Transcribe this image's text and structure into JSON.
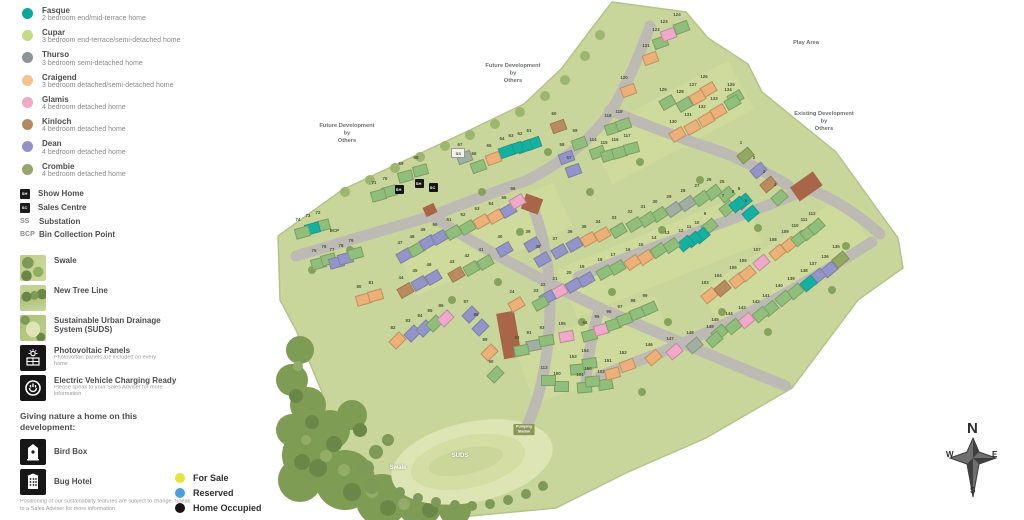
{
  "legend": {
    "house_types": [
      {
        "name": "Fasque",
        "desc": "2 bedroom end/mid-terrace home",
        "color": "#0aa79a"
      },
      {
        "name": "Cupar",
        "desc": "3 bedroom end-terrace/semi-detached home",
        "color": "#c6da85"
      },
      {
        "name": "Thurso",
        "desc": "3 bedroom semi-detached home",
        "color": "#8e9496"
      },
      {
        "name": "Craigend",
        "desc": "3 bedroom detached/semi-detached home",
        "color": "#f2c38e"
      },
      {
        "name": "Glamis",
        "desc": "4 bedroom detached home",
        "color": "#efaac6"
      },
      {
        "name": "Kinloch",
        "desc": "4 bedroom detached home",
        "color": "#b58a62"
      },
      {
        "name": "Dean",
        "desc": "4 bedroom detached home",
        "color": "#9590c9"
      },
      {
        "name": "Crombie",
        "desc": "4 bedroom detached home",
        "color": "#95a56b"
      }
    ],
    "markers": [
      {
        "code": "SH",
        "label": "Show Home",
        "style": "badge"
      },
      {
        "code": "SC",
        "label": "Sales Centre",
        "style": "badge"
      },
      {
        "code": "SS",
        "label": "Substation",
        "style": "text"
      },
      {
        "code": "BCP",
        "label": "Bin Collection Point",
        "style": "text"
      }
    ],
    "features": [
      {
        "label": "Swale",
        "icon": "swale-thumbnail",
        "thumb": "thumb-swale",
        "note": ""
      },
      {
        "label": "New Tree Line",
        "icon": "tree-line-thumbnail",
        "thumb": "thumb-tree",
        "note": ""
      },
      {
        "label": "Sustainable Urban Drainage System (SUDS)",
        "icon": "suds-thumbnail",
        "thumb": "thumb-suds",
        "note": ""
      },
      {
        "label": "Photovoltaic Panels",
        "icon": "pv-icon",
        "thumb": "",
        "note": "Photovoltaic panels are included on every home"
      },
      {
        "label": "Electric Vehicle Charging Ready",
        "icon": "ev-icon",
        "thumb": "",
        "note": "Please speak to your Sales Adviser for more information"
      }
    ],
    "nature_heading": "Giving nature a home on this development:",
    "nature_items": [
      {
        "label": "Bird Box",
        "icon": "bird-box-icon"
      },
      {
        "label": "Bug Hotel",
        "icon": "bug-hotel-icon"
      }
    ],
    "disclaimer": "Positioning of our sustainability features are subject to change. Speak to a Sales Adviser for more information.",
    "status": [
      {
        "label": "For Sale",
        "color": "#e8e23d"
      },
      {
        "label": "Reserved",
        "color": "#4a9fe0"
      },
      {
        "label": "Home Occupied",
        "color": "#1a1214"
      }
    ]
  },
  "map": {
    "palette": {
      "teal": "#12b2a3",
      "green": "#90bf7b",
      "gray": "#9fafa3",
      "orange": "#edb077",
      "pink": "#f0a8cb",
      "brown": "#bb8a5f",
      "purple": "#9294cb",
      "olive": "#93a961"
    },
    "labels": [
      {
        "lines": [
          "Play Area"
        ],
        "x": 806,
        "y": 39,
        "cls": "gray"
      },
      {
        "lines": [
          "Future Development",
          "by",
          "Others"
        ],
        "x": 513,
        "y": 62,
        "cls": "gray"
      },
      {
        "lines": [
          "Future Development",
          "by",
          "Others"
        ],
        "x": 347,
        "y": 122,
        "cls": "gray"
      },
      {
        "lines": [
          "Existing Development",
          "by",
          "Others"
        ],
        "x": 824,
        "y": 110,
        "cls": "gray"
      },
      {
        "lines": [
          "Swale"
        ],
        "x": 398,
        "y": 464,
        "cls": "white"
      },
      {
        "lines": [
          "SUDS"
        ],
        "x": 460,
        "y": 452,
        "cls": "white"
      },
      {
        "lines": [
          "Pumping",
          "Station"
        ],
        "x": 524,
        "y": 424,
        "cls": "chip"
      }
    ],
    "site_markers": [
      {
        "code": "SH",
        "x": 399,
        "y": 189,
        "type": "badge"
      },
      {
        "code": "SH",
        "x": 419,
        "y": 183,
        "type": "badge"
      },
      {
        "code": "SC",
        "x": 433,
        "y": 187,
        "type": "badge"
      },
      {
        "code": "SS",
        "x": 457,
        "y": 152,
        "type": "ss"
      },
      {
        "code": "BCP",
        "x": 334,
        "y": 230,
        "type": "text"
      }
    ],
    "compass": {
      "n": "N",
      "e": "E",
      "s": "S",
      "w": "W"
    },
    "houses": [
      [
        1,
        745,
        155,
        "olive",
        -40
      ],
      [
        2,
        758,
        170,
        "purple",
        -40
      ],
      [
        3,
        768,
        184,
        "brown",
        -40
      ],
      [
        4,
        779,
        197,
        "green",
        -40
      ],
      [
        5,
        743,
        201,
        "teal",
        -40
      ],
      [
        6,
        750,
        213,
        "teal",
        -40
      ],
      [
        7,
        727,
        208,
        "green",
        -40
      ],
      [
        8,
        737,
        204,
        "teal",
        -40
      ],
      [
        9,
        709,
        226,
        "green",
        -40
      ],
      [
        10,
        701,
        235,
        "teal",
        -40
      ],
      [
        11,
        693,
        239,
        "teal",
        -40
      ],
      [
        12,
        685,
        243,
        "teal",
        -40
      ],
      [
        13,
        671,
        245,
        "green",
        -35
      ],
      [
        14,
        658,
        250,
        "green",
        -35
      ],
      [
        15,
        645,
        257,
        "orange",
        -35
      ],
      [
        16,
        632,
        262,
        "orange",
        -35
      ],
      [
        17,
        617,
        267,
        "green",
        -30
      ],
      [
        18,
        604,
        272,
        "green",
        -30
      ],
      [
        19,
        586,
        279,
        "purple",
        -30
      ],
      [
        20,
        573,
        285,
        "purple",
        -30
      ],
      [
        21,
        559,
        291,
        "pink",
        -30
      ],
      [
        22,
        547,
        297,
        "purple",
        -30
      ],
      [
        23,
        540,
        303,
        "green",
        -30
      ],
      [
        24,
        516,
        304,
        "orange",
        -30
      ],
      [
        25,
        726,
        194,
        "green",
        -40
      ],
      [
        26,
        713,
        192,
        "green",
        -38
      ],
      [
        27,
        701,
        198,
        "green",
        -36
      ],
      [
        28,
        687,
        203,
        "gray",
        -35
      ],
      [
        29,
        673,
        209,
        "gray",
        -35
      ],
      [
        30,
        659,
        214,
        "green",
        -34
      ],
      [
        31,
        647,
        219,
        "green",
        -33
      ],
      [
        32,
        634,
        224,
        "green",
        -32
      ],
      [
        33,
        618,
        230,
        "green",
        -31
      ],
      [
        34,
        602,
        234,
        "orange",
        -30
      ],
      [
        35,
        588,
        239,
        "orange",
        -30
      ],
      [
        36,
        574,
        244,
        "purple",
        -30
      ],
      [
        37,
        559,
        251,
        "purple",
        -30
      ],
      [
        38,
        542,
        259,
        "purple",
        -30
      ],
      [
        39,
        532,
        244,
        "purple",
        -30
      ],
      [
        40,
        504,
        249,
        "purple",
        -30
      ],
      [
        41,
        485,
        262,
        "green",
        -30
      ],
      [
        42,
        471,
        268,
        "green",
        -30
      ],
      [
        43,
        456,
        274,
        "brown",
        -30
      ],
      [
        44,
        405,
        290,
        "brown",
        -30
      ],
      [
        45,
        419,
        283,
        "purple",
        -30
      ],
      [
        46,
        433,
        277,
        "purple",
        -30
      ],
      [
        47,
        404,
        255,
        "purple",
        -30
      ],
      [
        48,
        416,
        249,
        "green",
        -30
      ],
      [
        49,
        427,
        242,
        "purple",
        -30
      ],
      [
        50,
        439,
        237,
        "purple",
        -30
      ],
      [
        51,
        453,
        232,
        "green",
        -30
      ],
      [
        52,
        467,
        227,
        "green",
        -30
      ],
      [
        53,
        481,
        221,
        "orange",
        -30
      ],
      [
        54,
        495,
        216,
        "orange",
        -30
      ],
      [
        55,
        508,
        210,
        "purple",
        -30
      ],
      [
        56,
        517,
        201,
        "pink",
        -30
      ],
      [
        57,
        573,
        170,
        "purple",
        -20
      ],
      [
        58,
        566,
        157,
        "purple",
        -20
      ],
      [
        59,
        579,
        143,
        "green",
        -20
      ],
      [
        60,
        558,
        126,
        "brown",
        -20
      ],
      [
        61,
        533,
        143,
        "teal",
        -20
      ],
      [
        62,
        524,
        146,
        "teal",
        -20
      ],
      [
        63,
        515,
        148,
        "teal",
        -20
      ],
      [
        64,
        506,
        151,
        "teal",
        -20
      ],
      [
        65,
        493,
        158,
        "orange",
        -20
      ],
      [
        66,
        478,
        166,
        "green",
        -20
      ],
      [
        67,
        464,
        157,
        "gray",
        -20
      ],
      [
        68,
        420,
        170,
        "green",
        -15
      ],
      [
        69,
        405,
        176,
        "green",
        -15
      ],
      [
        70,
        389,
        191,
        "green",
        -15
      ],
      [
        71,
        378,
        195,
        "green",
        -15
      ],
      [
        72,
        322,
        225,
        "green",
        -15
      ],
      [
        73,
        312,
        228,
        "teal",
        -15
      ],
      [
        74,
        302,
        232,
        "green",
        -15
      ],
      [
        75,
        318,
        263,
        "green",
        -15
      ],
      [
        76,
        328,
        259,
        "green",
        -15
      ],
      [
        77,
        336,
        262,
        "purple",
        -15
      ],
      [
        78,
        345,
        258,
        "purple",
        -15
      ],
      [
        79,
        355,
        253,
        "green",
        -15
      ],
      [
        80,
        363,
        299,
        "orange",
        -15
      ],
      [
        81,
        375,
        295,
        "orange",
        -15
      ],
      [
        82,
        397,
        340,
        "orange",
        -45
      ],
      [
        83,
        412,
        333,
        "purple",
        -45
      ],
      [
        84,
        424,
        328,
        "purple",
        -45
      ],
      [
        85,
        434,
        323,
        "green",
        -45
      ],
      [
        86,
        445,
        318,
        "pink",
        -45
      ],
      [
        87,
        470,
        314,
        "purple",
        -45
      ],
      [
        88,
        480,
        327,
        "purple",
        -45
      ],
      [
        89,
        489,
        352,
        "orange",
        -45
      ],
      [
        90,
        495,
        374,
        "green",
        -45
      ],
      [
        91,
        533,
        345,
        "gray",
        -10
      ],
      [
        92,
        521,
        350,
        "green",
        -10
      ],
      [
        93,
        546,
        340,
        "green",
        -10
      ],
      [
        94,
        589,
        335,
        "green",
        -15
      ],
      [
        95,
        601,
        329,
        "pink",
        -15
      ],
      [
        96,
        613,
        324,
        "green",
        -18
      ],
      [
        97,
        624,
        319,
        "green",
        -20
      ],
      [
        98,
        637,
        313,
        "green",
        -22
      ],
      [
        99,
        649,
        308,
        "green",
        -24
      ],
      [
        100,
        561,
        386,
        "green",
        0
      ],
      [
        101,
        584,
        387,
        "green",
        -5
      ],
      [
        102,
        605,
        384,
        "green",
        -10
      ],
      [
        103,
        709,
        295,
        "orange",
        -40
      ],
      [
        104,
        722,
        288,
        "brown",
        -40
      ],
      [
        105,
        737,
        280,
        "orange",
        -40
      ],
      [
        106,
        747,
        273,
        "orange",
        -40
      ],
      [
        107,
        761,
        262,
        "pink",
        -40
      ],
      [
        108,
        777,
        252,
        "orange",
        -40
      ],
      [
        109,
        789,
        244,
        "orange",
        -40
      ],
      [
        110,
        799,
        238,
        "green",
        -40
      ],
      [
        111,
        808,
        232,
        "green",
        -40
      ],
      [
        112,
        816,
        226,
        "green",
        -42
      ],
      [
        113,
        548,
        380,
        "green",
        0
      ],
      [
        114,
        597,
        152,
        "green",
        -20
      ],
      [
        115,
        608,
        155,
        "green",
        -18
      ],
      [
        116,
        619,
        152,
        "green",
        -16
      ],
      [
        117,
        631,
        148,
        "green",
        -15
      ],
      [
        118,
        612,
        128,
        "green",
        -18
      ],
      [
        119,
        623,
        124,
        "green",
        -18
      ],
      [
        120,
        628,
        90,
        "orange",
        -20
      ],
      [
        121,
        650,
        58,
        "orange",
        -20
      ],
      [
        122,
        660,
        42,
        "green",
        -20
      ],
      [
        123,
        668,
        34,
        "pink",
        -20
      ],
      [
        124,
        681,
        27,
        "green",
        -20
      ],
      [
        125,
        735,
        97,
        "green",
        -30
      ],
      [
        126,
        708,
        89,
        "orange",
        -30
      ],
      [
        127,
        697,
        97,
        "orange",
        -30
      ],
      [
        128,
        684,
        104,
        "green",
        -30
      ],
      [
        129,
        667,
        102,
        "green",
        -30
      ],
      [
        130,
        677,
        134,
        "orange",
        -30
      ],
      [
        131,
        692,
        127,
        "orange",
        -30
      ],
      [
        132,
        706,
        119,
        "orange",
        -30
      ],
      [
        133,
        718,
        111,
        "orange",
        -30
      ],
      [
        134,
        732,
        102,
        "green",
        -30
      ],
      [
        135,
        840,
        259,
        "olive",
        -40
      ],
      [
        136,
        829,
        269,
        "purple",
        -40
      ],
      [
        137,
        817,
        276,
        "purple",
        -40
      ],
      [
        138,
        808,
        283,
        "teal",
        -40
      ],
      [
        139,
        795,
        291,
        "green",
        -40
      ],
      [
        140,
        783,
        298,
        "green",
        -40
      ],
      [
        141,
        770,
        308,
        "green",
        -40
      ],
      [
        142,
        760,
        314,
        "green",
        -40
      ],
      [
        143,
        746,
        320,
        "pink",
        -40
      ],
      [
        144,
        733,
        326,
        "green",
        -40
      ],
      [
        145,
        719,
        332,
        "green",
        -40
      ],
      [
        146,
        653,
        357,
        "orange",
        -40
      ],
      [
        147,
        674,
        351,
        "pink",
        -40
      ],
      [
        148,
        694,
        345,
        "gray",
        -40
      ],
      [
        149,
        714,
        339,
        "green",
        -40
      ],
      [
        150,
        592,
        381,
        "green",
        -5
      ],
      [
        151,
        612,
        373,
        "orange",
        -15
      ],
      [
        152,
        627,
        365,
        "orange",
        -20
      ],
      [
        153,
        577,
        369,
        "green",
        -5
      ],
      [
        154,
        589,
        363,
        "green",
        -8
      ],
      [
        155,
        566,
        336,
        "pink",
        -10
      ]
    ]
  }
}
